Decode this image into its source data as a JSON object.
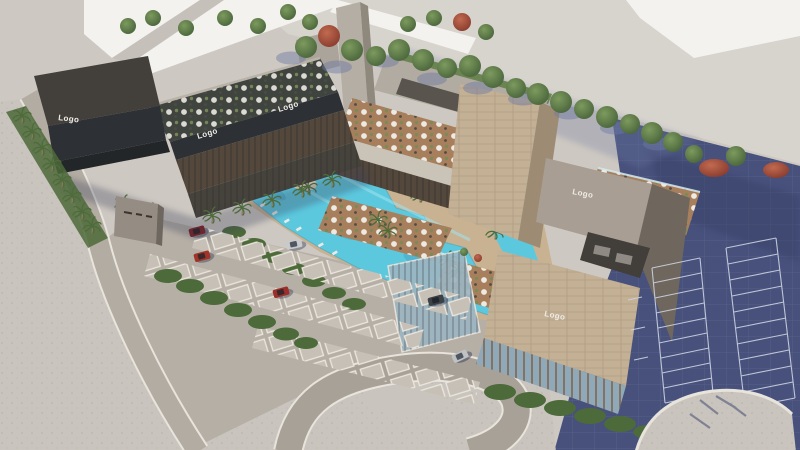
{
  "meta": {
    "description": "Aerial 3D architectural rendering of a commercial plaza with lagoon pool, rooftop terraces and parking lots"
  },
  "signs": [
    {
      "id": "logo-dark-building-end",
      "label": "Logo"
    },
    {
      "id": "logo-dark-wing-fascia-left",
      "label": "Logo"
    },
    {
      "id": "logo-dark-wing-fascia-right",
      "label": "Logo"
    },
    {
      "id": "logo-taupe-building",
      "label": "Logo"
    },
    {
      "id": "logo-stone-building",
      "label": "Logo"
    }
  ],
  "palette": {
    "ground": "#cdc8c1",
    "plaza": "#d7d3cd",
    "white_building": "#f3f2ef",
    "navy_pavement": "#47517c",
    "parking_asphalt": "#b6afa6",
    "sidewalk": "#c9c4bd",
    "road": "#a8a198",
    "curb_white": "#e8e4dc",
    "pool_water": "#5cc8de",
    "island_sand": "#dbd1b5",
    "deck_tan": "#c9b292",
    "terrace_wood": "#a87f5c",
    "hedge_green": "#4d6a3a",
    "shadow_blue": "#6e79a4",
    "charcoal_roof": "#43403c",
    "charcoal_face": "#2d3034",
    "glass_dark": "#54483c",
    "concrete": "#b4aea4",
    "stone_shade": "#9e8b73",
    "taupe": "#a89e93",
    "taupe_shade": "#6f675e",
    "glass_blue": "#8fa9b8"
  },
  "vehicles": [
    {
      "id": "car-maroon",
      "color": "#6b2631"
    },
    {
      "id": "car-red-1",
      "color": "#a13428"
    },
    {
      "id": "car-red-2",
      "color": "#9d2f2a"
    },
    {
      "id": "car-silver-1",
      "color": "#c9cacb"
    },
    {
      "id": "car-dark",
      "color": "#3c4147"
    },
    {
      "id": "car-silver-2",
      "color": "#bfc1c3"
    }
  ]
}
